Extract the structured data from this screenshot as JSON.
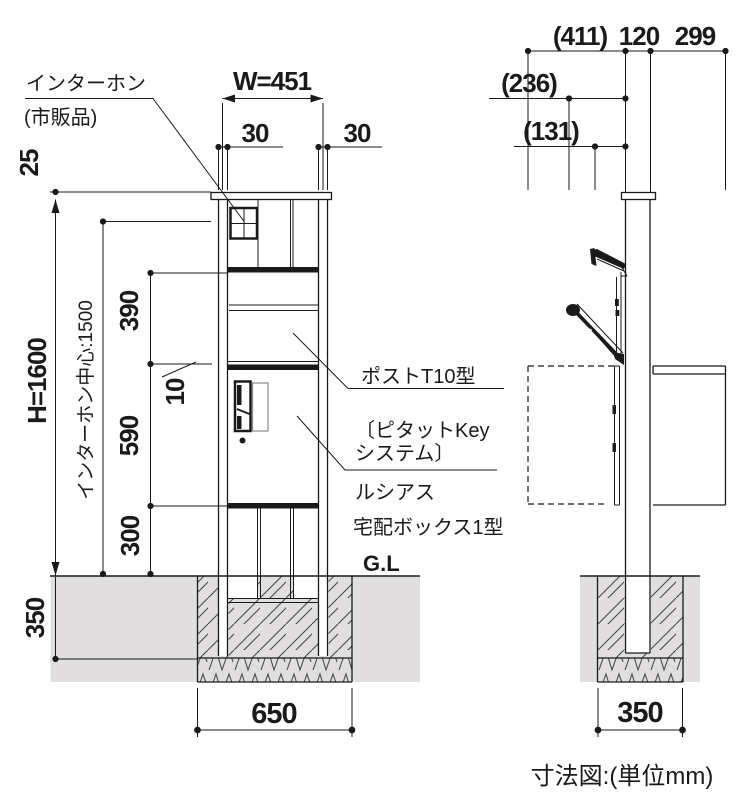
{
  "caption": "寸法図:(単位mm)",
  "colors": {
    "ground": "#e0dede",
    "line": "#1a1a1a",
    "hatch": "#4a4a4a"
  },
  "front_view": {
    "annotations": {
      "intercom": "インターホン",
      "intercom_note": "(市販品)",
      "post_model": "ポストT10型",
      "key_system_1": "〔ピタットKey",
      "key_system_2": "システム〕",
      "series": "ルシアス",
      "delivery_box": "宅配ボックス1型",
      "ground_line": "G.L"
    },
    "dims": {
      "width": "W=451",
      "side_left": "30",
      "side_right": "30",
      "cap": "25",
      "height": "H=1600",
      "intercom_center": "インターホン中心:1500",
      "post_section": "390",
      "gap": "10",
      "door_section": "590",
      "lower_section": "300",
      "embed_depth": "350",
      "foundation_width": "650"
    }
  },
  "side_view": {
    "dims": {
      "overall_depth": "(411)",
      "post_depth": "120",
      "body_depth": "299",
      "handle_depth": "(236)",
      "flap_depth": "(131)",
      "foundation_width": "350"
    }
  }
}
